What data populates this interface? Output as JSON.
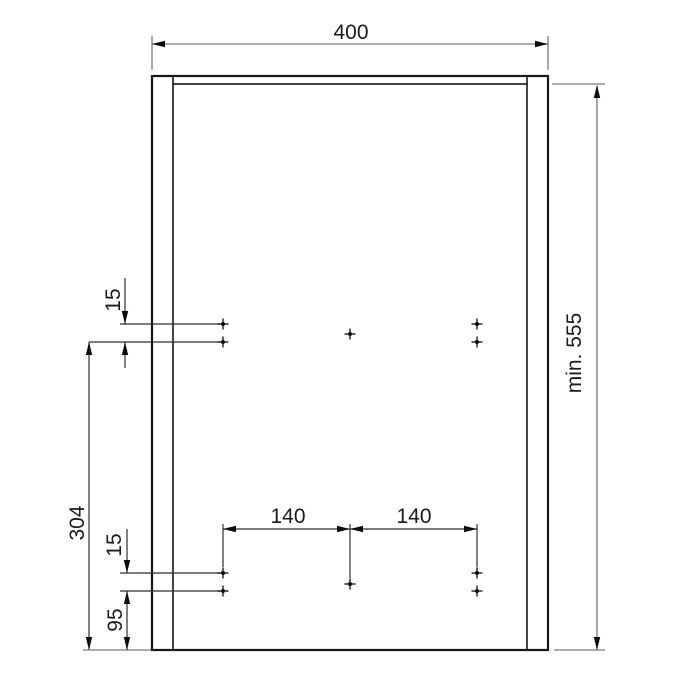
{
  "drawing": {
    "kind": "technical-dimension-drawing",
    "subject": "panel drilling template with hole positions",
    "labels": {
      "panel_width": "400",
      "panel_height": "min. 555",
      "top_hole_gap": "15",
      "row_span": "304",
      "bottom_hole_gap": "15",
      "bottom_edge_distance": "95",
      "hole_spacing_left": "140",
      "hole_spacing_right": "140"
    },
    "colors": {
      "background": "#ffffff",
      "edge_strip": "#f6e7c9",
      "panel_face": "#faf0dc",
      "outline": "#161616",
      "dimension_line_gray": "#7a7a7a",
      "dimension_line_dark": "#2f2f2f"
    },
    "drill_points": {
      "marker": "cross",
      "total": 10,
      "upper_row_count": 5,
      "lower_row_count": 5
    }
  }
}
